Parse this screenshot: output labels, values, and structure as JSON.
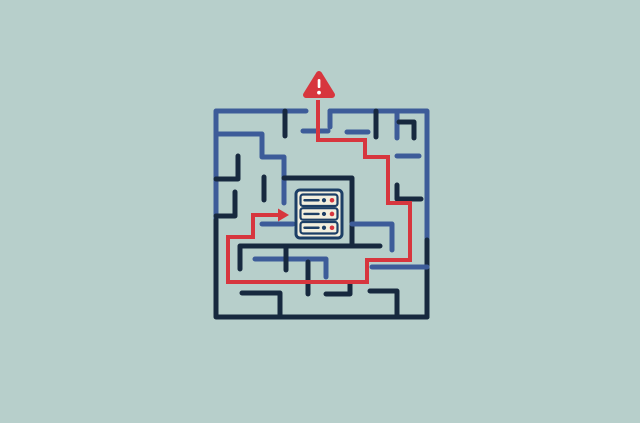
{
  "illustration": {
    "width": 640,
    "height": 423,
    "colors": {
      "background": "#b7cfcb",
      "blue": "#3d5c99",
      "navy": "#17293f",
      "red": "#d7363e",
      "server_border": "#1c3f66",
      "server_fill": "#f2efde",
      "white": "#ffffff"
    },
    "maze": {
      "stroke_width": 5,
      "walls": [
        {
          "c": "blue",
          "p": [
            [
              306,
              111
            ],
            [
              216,
              111
            ],
            [
              216,
              222
            ]
          ]
        },
        {
          "c": "navy",
          "p": [
            [
              216,
              220
            ],
            [
              216,
              317
            ],
            [
              427,
              317
            ]
          ]
        },
        {
          "c": "blue",
          "p": [
            [
              330,
              111
            ],
            [
              427,
              111
            ],
            [
              427,
              242
            ]
          ]
        },
        {
          "c": "navy",
          "p": [
            [
              427,
              240
            ],
            [
              427,
              317
            ]
          ]
        },
        {
          "c": "navy",
          "p": [
            [
              285,
              111
            ],
            [
              285,
              136
            ]
          ]
        },
        {
          "c": "blue",
          "p": [
            [
              216,
              134
            ],
            [
              262,
              134
            ],
            [
              262,
              157
            ],
            [
              284,
              157
            ],
            [
              284,
              203
            ]
          ]
        },
        {
          "c": "navy",
          "p": [
            [
              216,
              179
            ],
            [
              238,
              179
            ],
            [
              238,
              156
            ]
          ]
        },
        {
          "c": "navy",
          "p": [
            [
              264,
              177
            ],
            [
              264,
              200
            ]
          ]
        },
        {
          "c": "blue",
          "p": [
            [
              303,
              131
            ],
            [
              328,
              131
            ]
          ]
        },
        {
          "c": "blue",
          "p": [
            [
              330,
              111
            ],
            [
              330,
              127
            ]
          ]
        },
        {
          "c": "navy",
          "p": [
            [
              376,
              111
            ],
            [
              376,
              137
            ]
          ]
        },
        {
          "c": "blue",
          "p": [
            [
              397,
              111
            ],
            [
              397,
              138
            ]
          ]
        },
        {
          "c": "navy",
          "p": [
            [
              399,
              122
            ],
            [
              414,
              122
            ],
            [
              414,
              138
            ]
          ]
        },
        {
          "c": "blue",
          "p": [
            [
              347,
              132
            ],
            [
              368,
              132
            ]
          ]
        },
        {
          "c": "blue",
          "p": [
            [
              397,
              156
            ],
            [
              419,
              156
            ]
          ]
        },
        {
          "c": "navy",
          "p": [
            [
              284,
              178
            ],
            [
              352,
              178
            ],
            [
              352,
              246
            ]
          ]
        },
        {
          "c": "navy",
          "p": [
            [
              240,
              269
            ],
            [
              240,
              246
            ],
            [
              380,
              246
            ]
          ]
        },
        {
          "c": "blue",
          "p": [
            [
              262,
              224
            ],
            [
              293,
              224
            ]
          ]
        },
        {
          "c": "blue",
          "p": [
            [
              352,
              224
            ],
            [
              392,
              224
            ],
            [
              392,
              250
            ]
          ]
        },
        {
          "c": "navy",
          "p": [
            [
              235,
              192
            ],
            [
              235,
              216
            ],
            [
              216,
              216
            ]
          ]
        },
        {
          "c": "navy",
          "p": [
            [
              397,
              185
            ],
            [
              397,
              199
            ],
            [
              421,
              199
            ]
          ]
        },
        {
          "c": "blue",
          "p": [
            [
              255,
              259
            ],
            [
              326,
              259
            ],
            [
              326,
              277
            ]
          ]
        },
        {
          "c": "navy",
          "p": [
            [
              242,
              293
            ],
            [
              280,
              293
            ],
            [
              280,
              317
            ]
          ]
        },
        {
          "c": "navy",
          "p": [
            [
              308,
              262
            ],
            [
              308,
              294
            ]
          ]
        },
        {
          "c": "navy",
          "p": [
            [
              350,
              284
            ],
            [
              350,
              294
            ],
            [
              326,
              294
            ]
          ]
        },
        {
          "c": "blue",
          "p": [
            [
              372,
              267
            ],
            [
              427,
              267
            ]
          ]
        },
        {
          "c": "navy",
          "p": [
            [
              370,
              291
            ],
            [
              397,
              291
            ],
            [
              397,
              317
            ]
          ]
        },
        {
          "c": "navy",
          "p": [
            [
              286,
              246
            ],
            [
              286,
              270
            ]
          ]
        }
      ]
    },
    "threat_path": {
      "stroke_width": 4,
      "points": [
        [
          318,
          100
        ],
        [
          318,
          140
        ],
        [
          365,
          140
        ],
        [
          365,
          157
        ],
        [
          388,
          157
        ],
        [
          388,
          203
        ],
        [
          410,
          203
        ],
        [
          410,
          260
        ],
        [
          367,
          260
        ],
        [
          367,
          282
        ],
        [
          228,
          282
        ],
        [
          228,
          237
        ],
        [
          253,
          237
        ],
        [
          253,
          215
        ],
        [
          279,
          215
        ]
      ],
      "arrow_head": [
        [
          278,
          208.5
        ],
        [
          289,
          215
        ],
        [
          278,
          221.5
        ]
      ]
    },
    "warning_icon": {
      "triangle": [
        [
          319,
          74
        ],
        [
          306,
          95
        ],
        [
          332,
          95
        ]
      ],
      "triangle_stroke": 6,
      "bar": {
        "x": 317.7,
        "y": 79,
        "w": 2.7,
        "h": 9,
        "r": 1.3
      },
      "dot": {
        "cx": 319,
        "cy": 92.6,
        "r": 1.9
      }
    },
    "server_icon": {
      "box": {
        "x": 296,
        "y": 190,
        "w": 46,
        "h": 48,
        "r": 4,
        "stroke": 3
      },
      "rows": [
        {
          "x": 300.5,
          "y": 194.5,
          "w": 37,
          "h": 11.5
        },
        {
          "x": 300.5,
          "y": 208.2,
          "w": 37,
          "h": 11.5
        },
        {
          "x": 300.5,
          "y": 222,
          "w": 37,
          "h": 11.5
        }
      ],
      "row_r": 2.5,
      "row_stroke": 2.2,
      "vent_line": {
        "x1_off": 4,
        "x2_off": 18,
        "stroke": 2.4
      },
      "navy_dot": {
        "x_off": 23.5,
        "r": 2.1
      },
      "red_dot": {
        "x_off": 31.5,
        "r": 2.3
      }
    }
  }
}
